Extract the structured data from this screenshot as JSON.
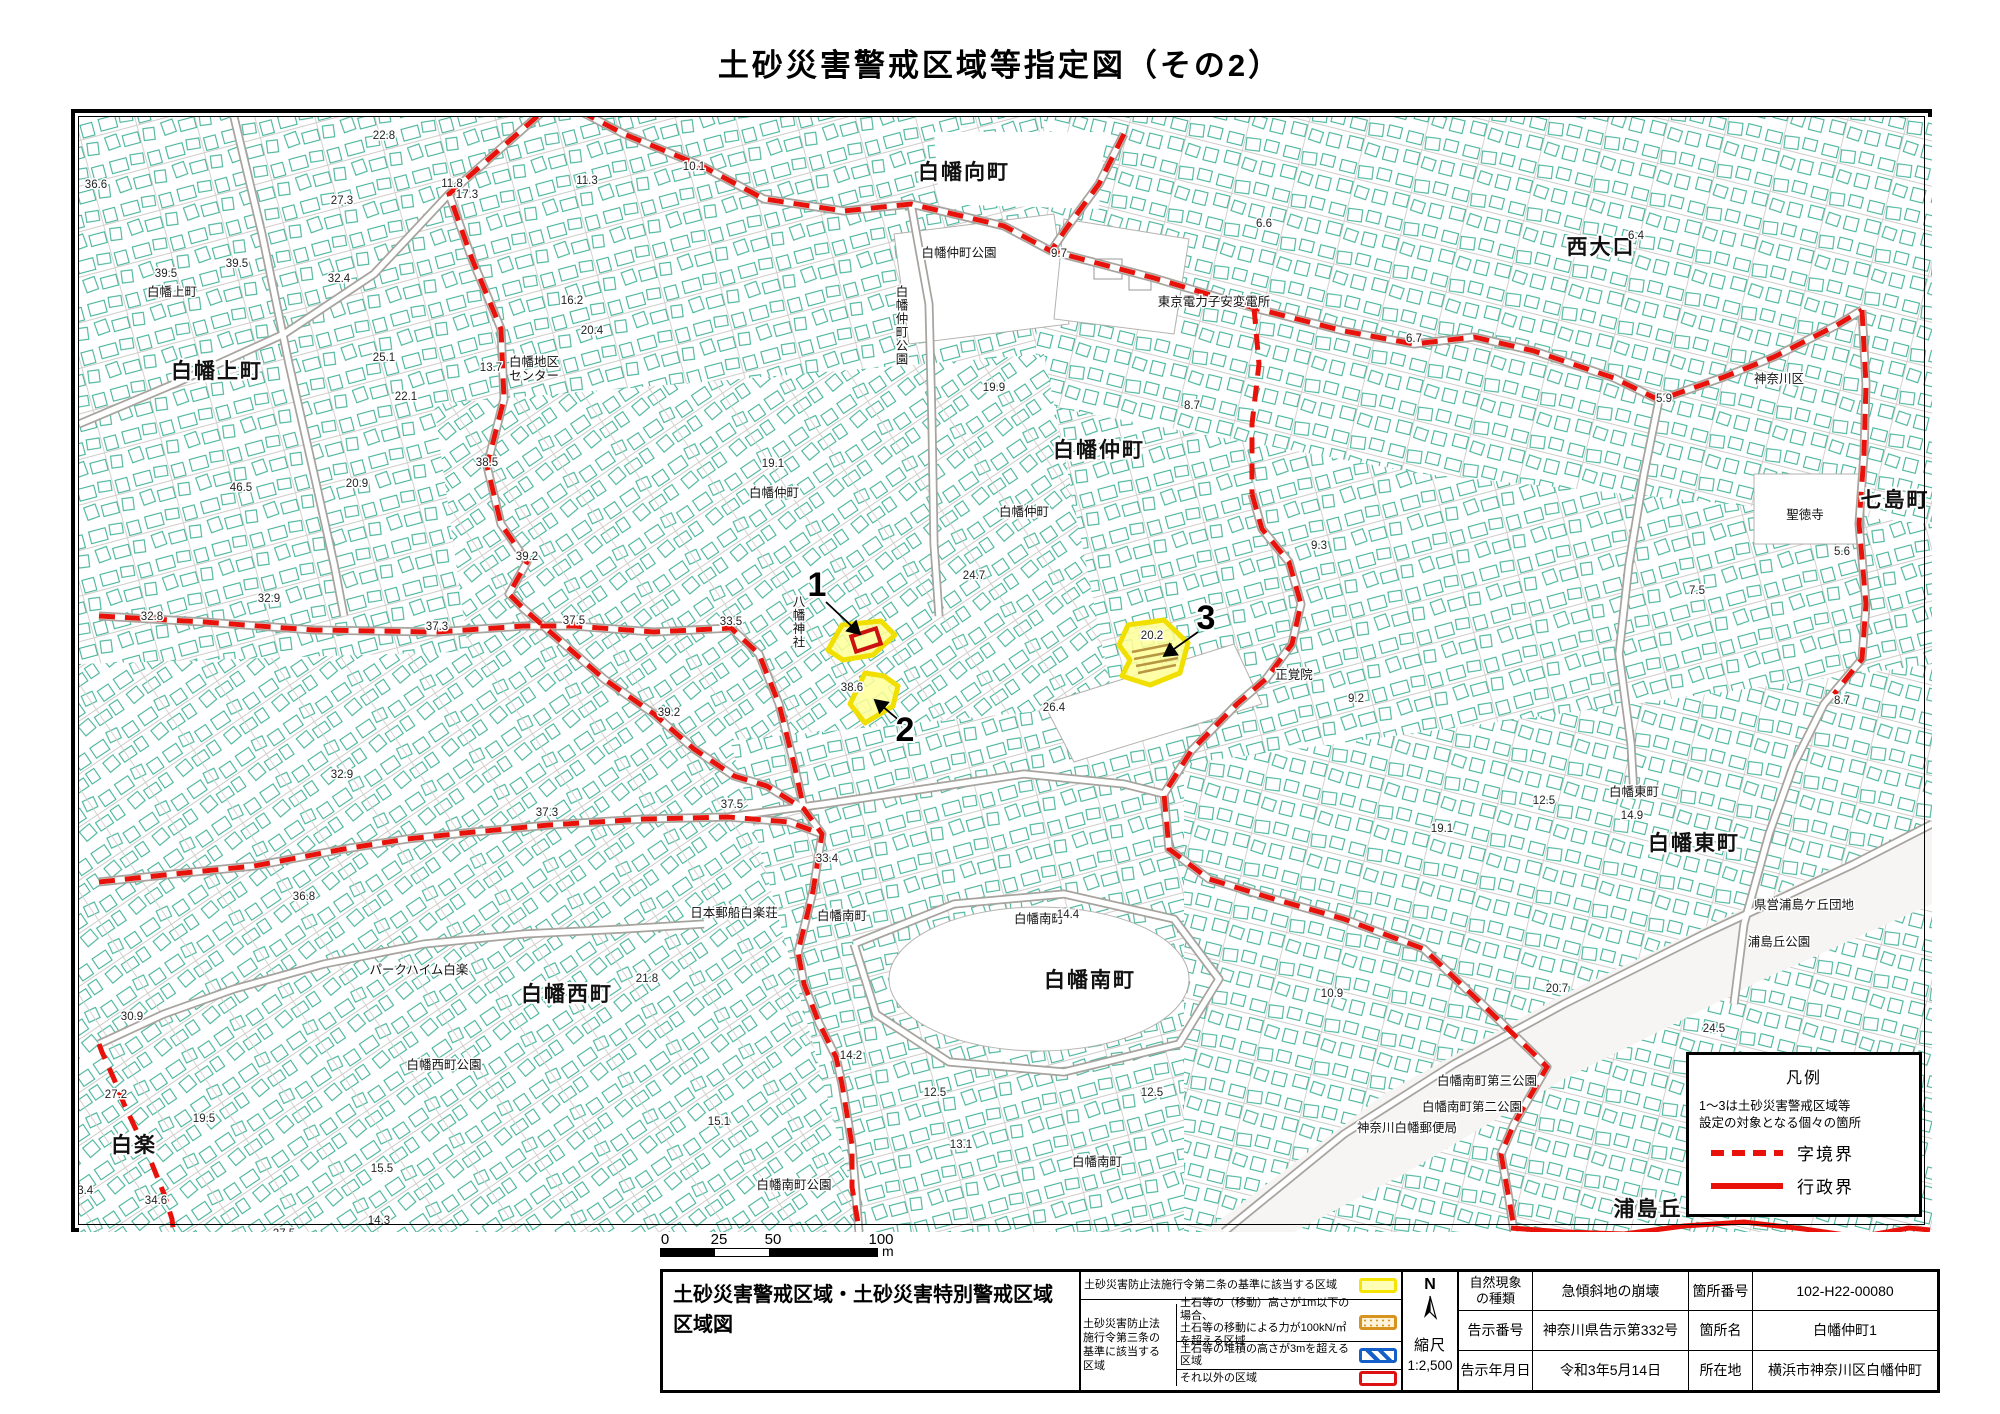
{
  "page": {
    "title": "土砂災害警戒区域等指定図（その2）"
  },
  "legend_box": {
    "title": "凡例",
    "note": "1〜3は土砂災害警戒区域等\n設定の対象となる個々の箇所",
    "dashed_label": "字境界",
    "solid_label": "行政界"
  },
  "scale_bar": {
    "ticks": [
      "0",
      "25",
      "50",
      "100"
    ],
    "unit": "m"
  },
  "map": {
    "zones": [
      {
        "id": "1",
        "x": 813,
        "y": 592
      },
      {
        "id": "2",
        "x": 901,
        "y": 737
      },
      {
        "id": "3",
        "x": 1202,
        "y": 625
      }
    ],
    "area_labels": [
      {
        "t": "白幡向町",
        "x": 960,
        "y": 175,
        "s": "big"
      },
      {
        "t": "白幡上町",
        "x": 213,
        "y": 374,
        "s": "big"
      },
      {
        "t": "白幡仲町",
        "x": 1095,
        "y": 453,
        "s": "big"
      },
      {
        "t": "西大口",
        "x": 1597,
        "y": 250,
        "s": "big"
      },
      {
        "t": "七島町",
        "x": 1891,
        "y": 503,
        "s": "big"
      },
      {
        "t": "白幡東町",
        "x": 1690,
        "y": 846,
        "s": "big"
      },
      {
        "t": "白幡南町",
        "x": 1086,
        "y": 983,
        "s": "big"
      },
      {
        "t": "白幡西町",
        "x": 563,
        "y": 997,
        "s": "big"
      },
      {
        "t": "白楽",
        "x": 130,
        "y": 1148,
        "s": "big"
      },
      {
        "t": "浦島丘",
        "x": 1644,
        "y": 1212,
        "s": "big"
      },
      {
        "t": "白幡仲町公園",
        "x": 955,
        "y": 253,
        "s": "small"
      },
      {
        "t": "白幡仲町公園",
        "x": 898,
        "y": 292,
        "s": "small",
        "v": true
      },
      {
        "t": "白幡地区\nセンター",
        "x": 530,
        "y": 362,
        "s": "small"
      },
      {
        "t": "東京電力子安変電所",
        "x": 1210,
        "y": 302,
        "s": "small"
      },
      {
        "t": "神奈川区",
        "x": 1775,
        "y": 379,
        "s": "small"
      },
      {
        "t": "聖徳寺",
        "x": 1801,
        "y": 515,
        "s": "small"
      },
      {
        "t": "正覚院",
        "x": 1290,
        "y": 675,
        "s": "small"
      },
      {
        "t": "白幡仲町",
        "x": 770,
        "y": 493,
        "s": "small"
      },
      {
        "t": "白幡仲町",
        "x": 1020,
        "y": 512,
        "s": "small"
      },
      {
        "t": "白幡上町",
        "x": 168,
        "y": 292,
        "s": "small"
      },
      {
        "t": "白幡東町",
        "x": 1630,
        "y": 792,
        "s": "small"
      },
      {
        "t": "白幡南町",
        "x": 838,
        "y": 916,
        "s": "small"
      },
      {
        "t": "白幡南町",
        "x": 1035,
        "y": 919,
        "s": "small"
      },
      {
        "t": "白幡南町",
        "x": 1093,
        "y": 1162,
        "s": "small"
      },
      {
        "t": "日本郵船白楽荘",
        "x": 730,
        "y": 913,
        "s": "small"
      },
      {
        "t": "パークハイム白楽",
        "x": 415,
        "y": 970,
        "s": "small"
      },
      {
        "t": "白幡西町公園",
        "x": 440,
        "y": 1065,
        "s": "small"
      },
      {
        "t": "白幡南町公園",
        "x": 790,
        "y": 1185,
        "s": "small"
      },
      {
        "t": "白幡南町第三公園",
        "x": 1483,
        "y": 1081,
        "s": "small"
      },
      {
        "t": "白幡南町第二公園",
        "x": 1468,
        "y": 1107,
        "s": "small"
      },
      {
        "t": "神奈川白幡郵便局",
        "x": 1403,
        "y": 1128,
        "s": "small"
      },
      {
        "t": "県営浦島ケ丘団地",
        "x": 1800,
        "y": 905,
        "s": "small"
      },
      {
        "t": "浦島丘公園",
        "x": 1775,
        "y": 942,
        "s": "small"
      },
      {
        "t": "八幡神社",
        "x": 795,
        "y": 602,
        "s": "small",
        "v": true
      }
    ],
    "elevations": [
      {
        "t": "36.6",
        "x": 92,
        "y": 184
      },
      {
        "t": "22.8",
        "x": 380,
        "y": 135
      },
      {
        "t": "27.3",
        "x": 338,
        "y": 200
      },
      {
        "t": "17.3",
        "x": 463,
        "y": 194
      },
      {
        "t": "11.8",
        "x": 448,
        "y": 183
      },
      {
        "t": "11.3",
        "x": 583,
        "y": 180
      },
      {
        "t": "10.1",
        "x": 690,
        "y": 166
      },
      {
        "t": "39.5",
        "x": 233,
        "y": 263
      },
      {
        "t": "39.5",
        "x": 162,
        "y": 273
      },
      {
        "t": "32.4",
        "x": 335,
        "y": 278
      },
      {
        "t": "16.2",
        "x": 568,
        "y": 300
      },
      {
        "t": "25.1",
        "x": 380,
        "y": 357
      },
      {
        "t": "13.7",
        "x": 487,
        "y": 367
      },
      {
        "t": "20.4",
        "x": 588,
        "y": 330
      },
      {
        "t": "22.1",
        "x": 402,
        "y": 396
      },
      {
        "t": "19.1",
        "x": 769,
        "y": 463
      },
      {
        "t": "9.7",
        "x": 1055,
        "y": 253
      },
      {
        "t": "6.6",
        "x": 1260,
        "y": 223
      },
      {
        "t": "6.7",
        "x": 1410,
        "y": 338
      },
      {
        "t": "19.9",
        "x": 990,
        "y": 387
      },
      {
        "t": "8.7",
        "x": 1188,
        "y": 405
      },
      {
        "t": "6.4",
        "x": 1632,
        "y": 235
      },
      {
        "t": "5.9",
        "x": 1660,
        "y": 398
      },
      {
        "t": "5.6",
        "x": 1838,
        "y": 551
      },
      {
        "t": "7.5",
        "x": 1693,
        "y": 590
      },
      {
        "t": "8.7",
        "x": 1838,
        "y": 700
      },
      {
        "t": "9.3",
        "x": 1315,
        "y": 545
      },
      {
        "t": "9.2",
        "x": 1352,
        "y": 698
      },
      {
        "t": "46.5",
        "x": 237,
        "y": 487
      },
      {
        "t": "20.9",
        "x": 353,
        "y": 483
      },
      {
        "t": "38.5",
        "x": 483,
        "y": 462
      },
      {
        "t": "39.2",
        "x": 523,
        "y": 556
      },
      {
        "t": "32.9",
        "x": 265,
        "y": 598
      },
      {
        "t": "32.8",
        "x": 148,
        "y": 616
      },
      {
        "t": "37.3",
        "x": 433,
        "y": 626
      },
      {
        "t": "37.5",
        "x": 570,
        "y": 620
      },
      {
        "t": "33.5",
        "x": 727,
        "y": 621
      },
      {
        "t": "20.2",
        "x": 1148,
        "y": 635
      },
      {
        "t": "24.7",
        "x": 970,
        "y": 575
      },
      {
        "t": "26.4",
        "x": 1050,
        "y": 707
      },
      {
        "t": "38.6",
        "x": 848,
        "y": 687
      },
      {
        "t": "39.2",
        "x": 665,
        "y": 712
      },
      {
        "t": "32.9",
        "x": 338,
        "y": 774
      },
      {
        "t": "37.3",
        "x": 543,
        "y": 812
      },
      {
        "t": "37.5",
        "x": 728,
        "y": 804
      },
      {
        "t": "36.8",
        "x": 300,
        "y": 896
      },
      {
        "t": "33.4",
        "x": 823,
        "y": 858
      },
      {
        "t": "12.5",
        "x": 1540,
        "y": 800
      },
      {
        "t": "19.1",
        "x": 1438,
        "y": 828
      },
      {
        "t": "14.9",
        "x": 1628,
        "y": 815
      },
      {
        "t": "21.8",
        "x": 643,
        "y": 978
      },
      {
        "t": "14.4",
        "x": 1064,
        "y": 914
      },
      {
        "t": "14.2",
        "x": 847,
        "y": 1055
      },
      {
        "t": "12.5",
        "x": 931,
        "y": 1092
      },
      {
        "t": "12.5",
        "x": 1148,
        "y": 1092
      },
      {
        "t": "13.1",
        "x": 957,
        "y": 1144
      },
      {
        "t": "15.1",
        "x": 715,
        "y": 1121
      },
      {
        "t": "10.9",
        "x": 1328,
        "y": 993
      },
      {
        "t": "20.7",
        "x": 1553,
        "y": 988
      },
      {
        "t": "24.5",
        "x": 1710,
        "y": 1028
      },
      {
        "t": "27.2",
        "x": 112,
        "y": 1094
      },
      {
        "t": "19.5",
        "x": 200,
        "y": 1118
      },
      {
        "t": "34.6",
        "x": 152,
        "y": 1200
      },
      {
        "t": "33.4",
        "x": 78,
        "y": 1190
      },
      {
        "t": "27.5",
        "x": 280,
        "y": 1233
      },
      {
        "t": "14.3",
        "x": 375,
        "y": 1220
      },
      {
        "t": "15.5",
        "x": 378,
        "y": 1168
      },
      {
        "t": "30.9",
        "x": 128,
        "y": 1016
      }
    ]
  },
  "title_block": {
    "doc_title": "土砂災害警戒区域・土砂災害特別警戒区域\n区域図",
    "legend": {
      "row1": "土砂災害防止法施行令第二条の基準に該当する区域",
      "group_label": "土砂災害防止法\n施行令第三条の\n基準に該当する\n区域",
      "row2": "土石等の（移動）高さが1m以下の場合、\n土石等の移動による力が100kN/㎡を超える区域",
      "row3": "土石等の堆積の高さが3mを超える区域",
      "row4": "それ以外の区域"
    },
    "north_label": "N",
    "scale_label": "縮尺",
    "scale_value": "1:2,500",
    "info_rows": [
      {
        "k1": "自然現象\nの種類",
        "v1": "急傾斜地の崩壊",
        "k2": "箇所番号",
        "v2": "102-H22-00080"
      },
      {
        "k1": "告示番号",
        "v1": "神奈川県告示第332号",
        "k2": "箇所名",
        "v2": "白幡仲町1"
      },
      {
        "k1": "告示年月日",
        "v1": "令和3年5月14日",
        "k2": "所在地",
        "v2": "横浜市神奈川区白幡仲町"
      }
    ]
  },
  "colors": {
    "boundary_red": "#e8120a",
    "building_teal": "#46b39a",
    "road_gray": "#a7a39e",
    "zone_yellow_fill": "#ffff99",
    "zone_yellow_border": "#f0df00",
    "swatch_orange": "#d8921e",
    "swatch_blue": "#1560c8",
    "swatch_red": "#dd1111"
  }
}
